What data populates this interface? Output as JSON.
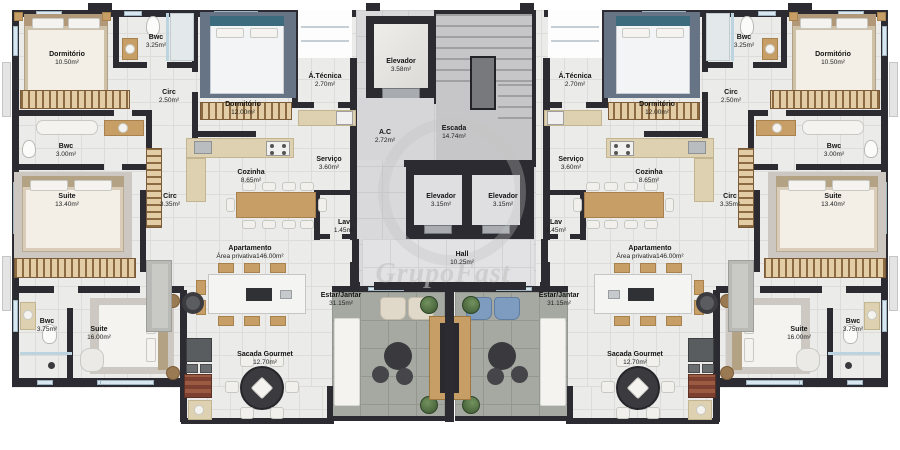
{
  "watermark": {
    "text": "GrupoFast"
  },
  "colors": {
    "wall": "#2b2b31",
    "floor_tile": "#ebebe9",
    "wood": "#c79f66",
    "terrace_floor": "#a5a9a2",
    "watermark_gray": "#c2c2c2"
  },
  "rooms": {
    "dormitorio_small": {
      "name": "Dormitório",
      "area": "10.50m²"
    },
    "bwc_small": {
      "name": "Bwc",
      "area": "3.25m²"
    },
    "circ_small": {
      "name": "Circ",
      "area": "2.50m²"
    },
    "dormitorio_mid": {
      "name": "Dormitório",
      "area": "12.00m²"
    },
    "area_tecnica": {
      "name": "Á.Técnica",
      "area": "2.70m²"
    },
    "servico": {
      "name": "Serviço",
      "area": "3.60m²"
    },
    "cozinha": {
      "name": "Cozinha",
      "area": "8.65m²"
    },
    "circ_mid": {
      "name": "Circ",
      "area": "3.35m²"
    },
    "bwc_mid": {
      "name": "Bwc",
      "area": "3.00m²"
    },
    "suite_mid": {
      "name": "Suite",
      "area": "13.40m²"
    },
    "lav": {
      "name": "Lav",
      "area": "1.45m²"
    },
    "apartamento": {
      "name": "Apartamento",
      "area": "Área privativa146.00m²"
    },
    "estar_jantar": {
      "name": "Estar/Jantar",
      "area": "31.15m²"
    },
    "bwc_suite": {
      "name": "Bwc",
      "area": "3.75m²"
    },
    "suite_master": {
      "name": "Suite",
      "area": "16.00m²"
    },
    "sacada": {
      "name": "Sacada Gourmet",
      "area": "12.70m²"
    },
    "elevador_top": {
      "name": "Elevador",
      "area": "3.58m²"
    },
    "escada": {
      "name": "Escada",
      "area": "14.74m²"
    },
    "ac": {
      "name": "A.C",
      "area": "2.72m²"
    },
    "elevador_left": {
      "name": "Elevador",
      "area": "3.15m²"
    },
    "elevador_right": {
      "name": "Elevador",
      "area": "3.15m²"
    },
    "hall": {
      "name": "Hall",
      "area": "10.25m²"
    }
  }
}
